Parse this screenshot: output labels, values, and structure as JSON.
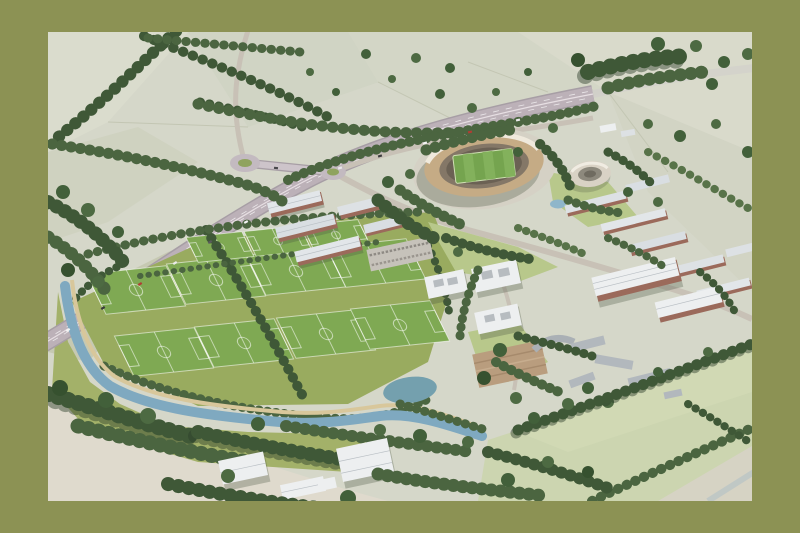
{
  "scene": {
    "type": "aerial-architectural-rendering",
    "alt": "Aerial masterplan rendering of a riverside sports and eco-business campus beside a motorway: an oval timber stadium with a green pitch, a circular arena, a grid of grass training football pitches, timber and brick campus buildings, a winding blue river with a riverside path, white warehouses among mature trees, and pale patchwork farmland criss-crossed by dark hedgerows, all inside an olive-green border.",
    "landmarks": {
      "stadium": "Oval timber-framed football stadium with green pitch",
      "arena": "Circular arena building east of the stadium",
      "training_pitches": "Grid of grass training football pitches with white markings",
      "motorway": "Dual-carriageway motorway running from lower left to upper right",
      "junction": "Motorway junction with two roundabouts linked by an overbridge",
      "river": "Blue river winding along the training pitches with a sandy riverside path",
      "wetland": "Oval wetland pond at the eastern end of the river",
      "campus": "Eco-business park of long light-roofed sheds and brick buildings",
      "offices": "Three white flat-roofed office blocks with rooftop plant",
      "warehouses": "White industrial sheds among dark trees at the bottom edge",
      "village": "Existing grey-roofed village buildings and pale green fields at lower right",
      "countryside": "Pale patchwork farmland with dark hedgerow tree lines at the top"
    },
    "counts": {
      "training_pitches": 11,
      "roundabouts": 2,
      "stadiums": 1,
      "arenas": 1,
      "office_blocks": 3
    }
  },
  "palette": {
    "border_olive": "#8c9254",
    "field_pale": "#d5d7c9",
    "meadow": "#99ab5f",
    "pitch_green": "#7fa953",
    "tree_dark": "#3f5837",
    "motorway_surface": "#bcb1b8",
    "local_road": "#c8c1b6",
    "river": "#7fa9c0",
    "riverside_path": "#d8c79b",
    "stadium_timber": "#c5ab85",
    "stadium_pitch": "#75a44f",
    "arena_shell": "#d9d2c5",
    "roof_light": "#e2e6e9",
    "brick": "#9b6a5b",
    "lawn": "#b8c88b",
    "village_field": "#ccd5b0"
  }
}
